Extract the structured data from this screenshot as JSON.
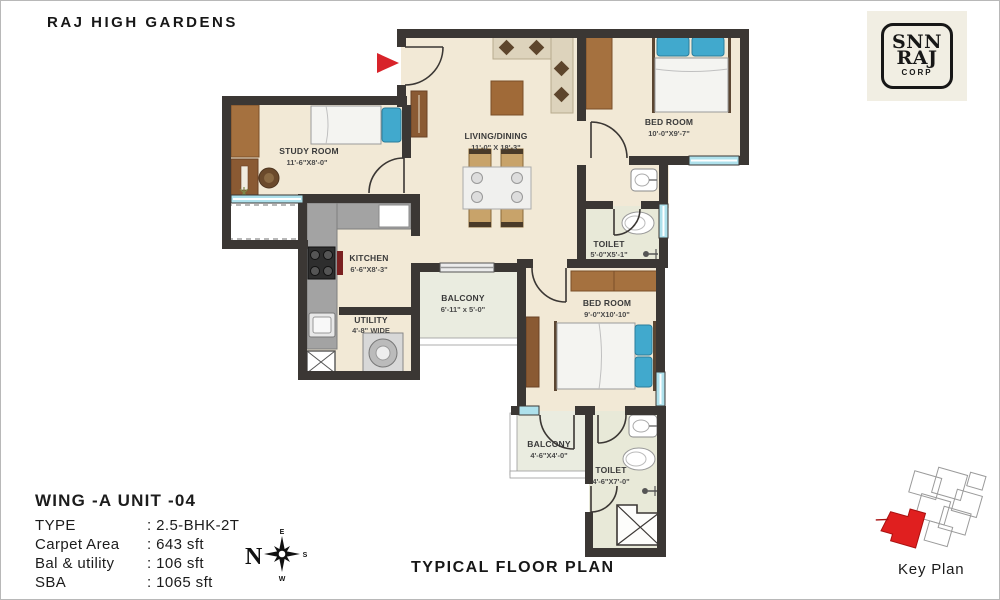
{
  "page": {
    "title": "RAJ HIGH GARDENS",
    "footer": "TYPICAL FLOOR PLAN"
  },
  "logo": {
    "line1": "SNN",
    "line2": "RAJ",
    "line3": "CORP"
  },
  "unit_info": {
    "heading": "WING -A  UNIT -04",
    "rows": [
      {
        "label": "TYPE",
        "value": ": 2.5-BHK-2T"
      },
      {
        "label": "Carpet Area",
        "value": ": 643 sft"
      },
      {
        "label": "Bal & utility",
        "value": ": 106 sft"
      },
      {
        "label": "SBA",
        "value": ": 1065 sft"
      }
    ]
  },
  "key_plan": {
    "label": "Key Plan"
  },
  "compass": {
    "n": "N",
    "e": "E",
    "s": "S",
    "w": "W"
  },
  "rooms": {
    "study": {
      "name": "STUDY ROOM",
      "dims": "11'-6\"X8'-0\""
    },
    "living": {
      "name": "LIVING/DINING",
      "dims": "11'-0\" X 18'-3\""
    },
    "bedroom1": {
      "name": "BED ROOM",
      "dims": "10'-0\"X9'-7\""
    },
    "toilet1": {
      "name": "TOILET",
      "dims": "5'-0\"X5'-1\""
    },
    "kitchen": {
      "name": "KITCHEN",
      "dims": "6'-6\"X8'-3\""
    },
    "utility": {
      "name": "UTILITY",
      "dims": "4'-8\" WIDE"
    },
    "balcony1": {
      "name": "BALCONY",
      "dims": "6'-11\" x 5'-0\""
    },
    "bedroom2": {
      "name": "BED ROOM",
      "dims": "9'-0\"X10'-10\""
    },
    "balcony2": {
      "name": "BALCONY",
      "dims": "4'-6\"X4'-0\""
    },
    "toilet2": {
      "name": "TOILET",
      "dims": "4'-6\"X7'-0\""
    }
  },
  "colors": {
    "wall": "#3b3734",
    "accent_red": "#d8232a",
    "window_teal": "#aee1ec",
    "floor": "#f2e9d6"
  }
}
